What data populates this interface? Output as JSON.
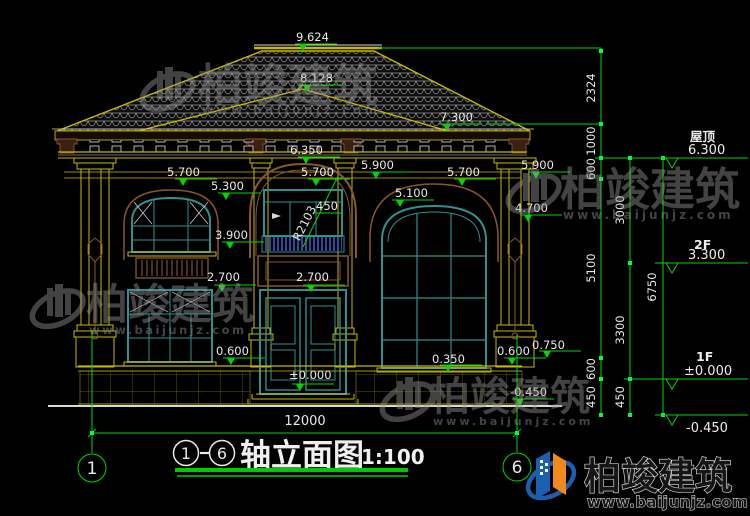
{
  "title": {
    "axis_from": "1",
    "axis_to": "6",
    "name": "轴立面图",
    "scale": "1:100"
  },
  "axes": {
    "left": "1",
    "right": "6"
  },
  "marks": {
    "m9624": "9.624",
    "m8128": "8.128",
    "m7300": "7.300",
    "m6350": "6.350",
    "m5900": "5.900",
    "m5700": "5.700",
    "m5300": "5.300",
    "m5100": "5.100",
    "m4700": "4.700",
    "m3900": "3.900",
    "m2700": "2.700",
    "m0750": "0.750",
    "m0600": "0.600",
    "m0350": "0.350",
    "m0000": "±0.000",
    "mneg450": "-0.450",
    "rail450": "450",
    "radius": "R2103",
    "total_width": "12000"
  },
  "chains": {
    "c2324": "2324",
    "c1000": "1000",
    "c600": "600",
    "c5100": "5100",
    "c450": "450",
    "c3000": "3000",
    "c3300": "3300",
    "c6750": "6750"
  },
  "levels": {
    "roof_label": "屋顶",
    "roof_value": "6.300",
    "f2_label": "2F",
    "f2_value": "3.300",
    "f1_label": "1F",
    "f1_value": "±0.000",
    "base_value": "-0.450"
  },
  "watermark": {
    "brand": "柏竣建筑",
    "url": "www.baijunjz.com"
  },
  "logo": {
    "brand": "柏竣建筑",
    "url": "www.baijunjz.com"
  },
  "colors": {
    "dim_green": "#00d800",
    "cad_yellow": "#c9b700",
    "cad_teal": "#2f9090",
    "cad_brown": "#8a5530",
    "railing_blue": "#2a4b9b",
    "logo_blue": "#1b5fb0",
    "logo_orange": "#f08a1d",
    "background": "#000000"
  }
}
